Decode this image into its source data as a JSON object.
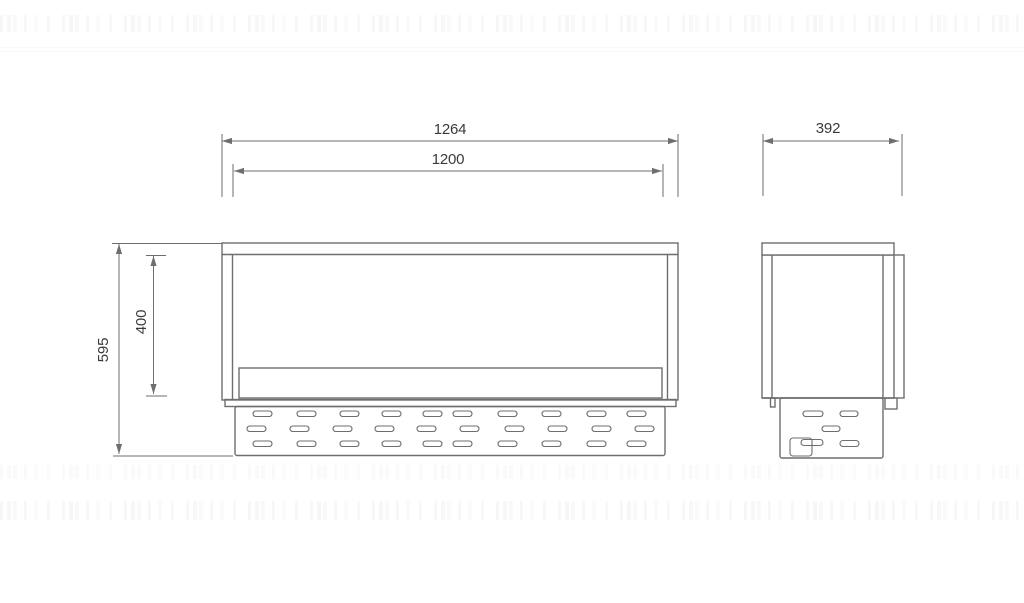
{
  "drawing": {
    "type": "technical-dimension-drawing",
    "views": [
      "front-elevation",
      "side-elevation"
    ],
    "line_color": "#6e6e6e",
    "text_color": "#3a3a3a",
    "background_color": "#ffffff",
    "dimensions": {
      "front_outer_width": {
        "value": "1264"
      },
      "front_inner_width": {
        "value": "1200"
      },
      "front_total_height": {
        "value": "595"
      },
      "front_opening_height": {
        "value": "400"
      },
      "side_depth": {
        "value": "392"
      }
    },
    "front_view": {
      "perforation": {
        "slot_w": 19,
        "slot_h": 5.5,
        "rows": [
          {
            "y": 411,
            "x": [
              253,
              297,
              340,
              382,
              423,
              453,
              498,
              542,
              587,
              627
            ]
          },
          {
            "y": 426,
            "x": [
              247,
              290,
              333,
              375,
              417,
              460,
              505,
              548,
              592,
              635
            ]
          },
          {
            "y": 441,
            "x": [
              253,
              297,
              340,
              382,
              423,
              453,
              498,
              542,
              587,
              627
            ]
          }
        ]
      }
    },
    "side_view": {
      "perforation": {
        "slots": [
          [
            803,
            411,
            20,
            5.5
          ],
          [
            840,
            411,
            18,
            5.5
          ],
          [
            822,
            426,
            18,
            5.5
          ],
          [
            801,
            439.5,
            22,
            6
          ],
          [
            840,
            440.5,
            19,
            6
          ]
        ],
        "valve_box": [
          790,
          438,
          22,
          18
        ]
      }
    }
  }
}
